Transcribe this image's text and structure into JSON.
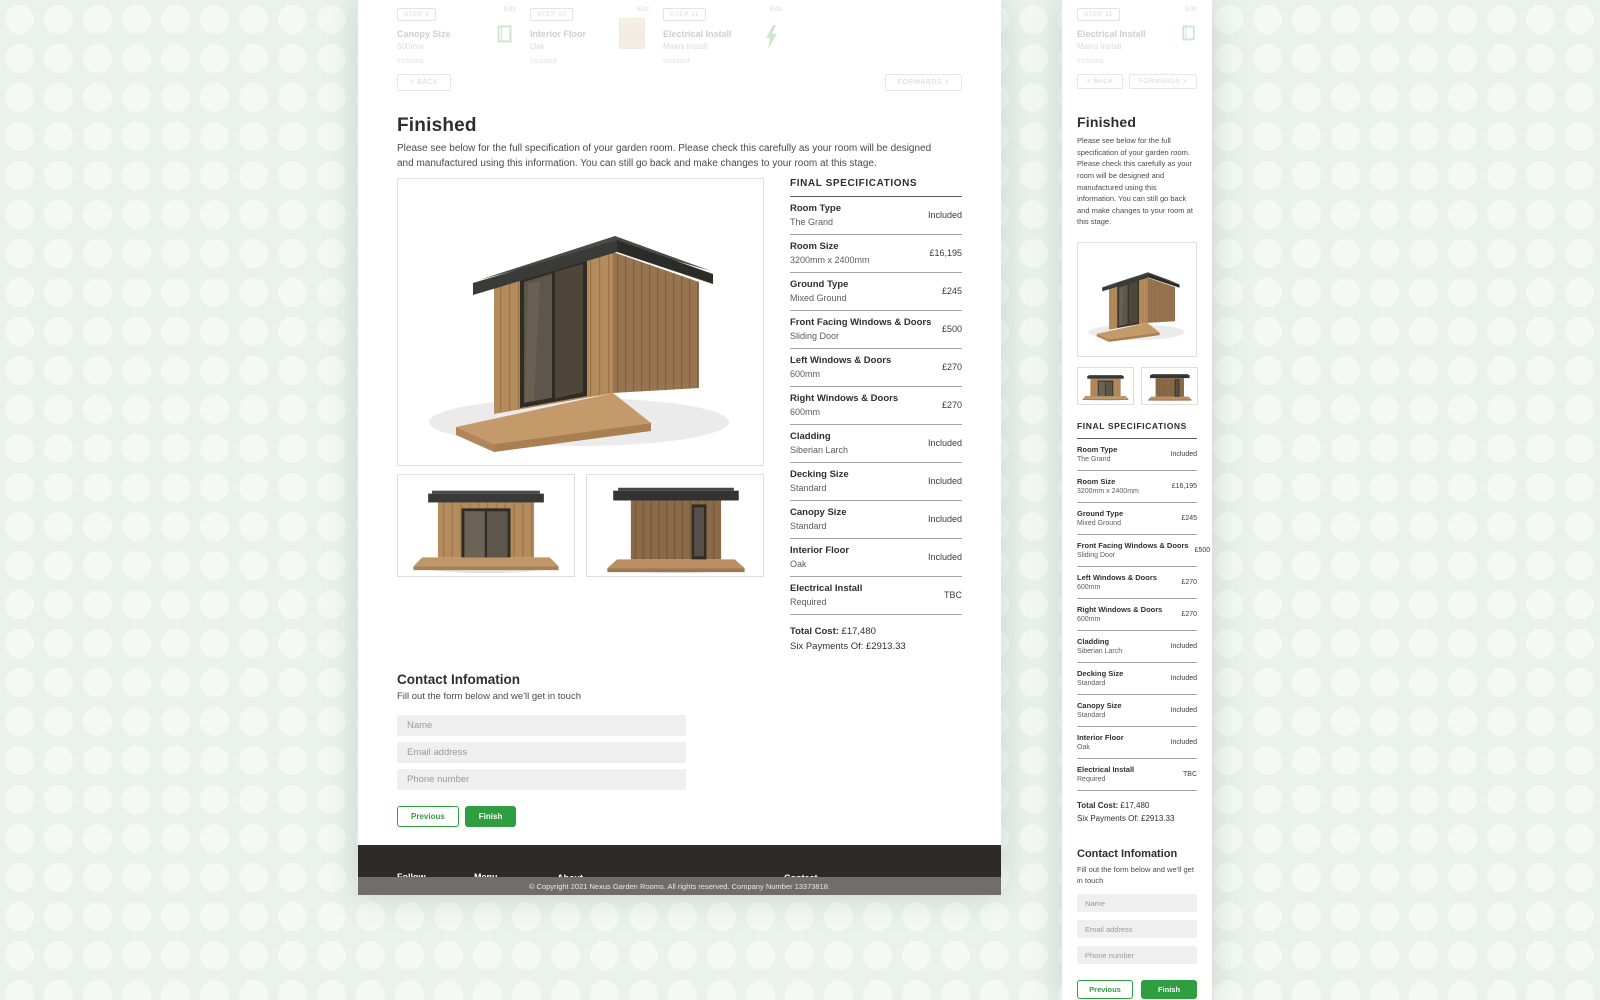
{
  "colors": {
    "accent_green": "#2F9E41",
    "footer_bg": "#2D2B27",
    "copyright_bg": "#6F6E6B"
  },
  "wizard": {
    "steps": [
      {
        "badge": "STEP 9",
        "title": "Canopy Size",
        "value": "600mm",
        "status": "Included",
        "edit_label": "Edit"
      },
      {
        "badge": "STEP 10",
        "title": "Interior Floor",
        "value": "Oak",
        "status": "Included",
        "edit_label": "Edit"
      },
      {
        "badge": "STEP 11",
        "title": "Electrical Install",
        "value": "Mains Install",
        "status": "Included",
        "edit_label": "Edit"
      }
    ],
    "back_label": "< BACK",
    "forwards_label": "FORWARDS >"
  },
  "page": {
    "title": "Finished",
    "description": "Please see below for the full specification of your garden room. Please check this carefully as your room will be designed and manufactured using this information. You can still go back and make changes to your room at this stage."
  },
  "specs": {
    "heading": "FINAL SPECIFICATIONS",
    "rows": [
      {
        "label": "Room Type",
        "value": "The Grand",
        "price": "Included"
      },
      {
        "label": "Room Size",
        "value": "3200mm x 2400mm",
        "price": "£16,195"
      },
      {
        "label": "Ground Type",
        "value": "Mixed Ground",
        "price": "£245"
      },
      {
        "label": "Front Facing Windows & Doors",
        "value": "Sliding Door",
        "price": "£500"
      },
      {
        "label": "Left Windows & Doors",
        "value": "600mm",
        "price": "£270"
      },
      {
        "label": "Right Windows & Doors",
        "value": "600mm",
        "price": "£270"
      },
      {
        "label": "Cladding",
        "value": "Siberian Larch",
        "price": "Included"
      },
      {
        "label": "Decking Size",
        "value": "Standard",
        "price": "Included"
      },
      {
        "label": "Canopy Size",
        "value": "Standard",
        "price": "Included"
      },
      {
        "label": "Interior Floor",
        "value": "Oak",
        "price": "Included"
      },
      {
        "label": "Electrical Install",
        "value": "Required",
        "price": "TBC"
      }
    ],
    "total_label": "Total Cost:",
    "total_value": "£17,480",
    "payments_label": "Six Payments Of:",
    "payments_value": "£2913.33"
  },
  "contact_form": {
    "heading": "Contact Infomation",
    "subheading": "Fill out the form below and we'll get in touch",
    "name_placeholder": "Name",
    "email_placeholder": "Email address",
    "phone_placeholder": "Phone number",
    "previous_label": "Previous",
    "finish_label": "Finish"
  },
  "footer": {
    "follow_heading": "Follow",
    "follow_links": [
      "Facebook",
      "Twitter",
      "Instagram",
      "YouTube",
      "LinkedIn"
    ],
    "menu_heading": "Menu",
    "menu_links": [
      "Our Process",
      "Materials",
      "Gallery",
      "About",
      "Contact"
    ],
    "about_heading": "About",
    "about_text": "Nexus garden rooms was built on perfection, durability and sustainability. All of our rooms are designed and manufactured in the UK, using locally sourced materials and labour. Our factory has been designing and manufacturing products since 2001 with a wealth of experience using various material types.",
    "contact_heading": "Contact",
    "address_lines": [
      "Unit 12, Templars Way Industrial Estate,",
      "Marlborough Road,",
      "Royal Wootton Bassett,",
      "SN4 7SR"
    ],
    "email": "hello@nexusgardenrooms.com",
    "phone": "0330 107 2989",
    "copyright": "© Copyright 2021 Nexus Garden Rooms. All rights reserved. Company Number 13373818."
  }
}
